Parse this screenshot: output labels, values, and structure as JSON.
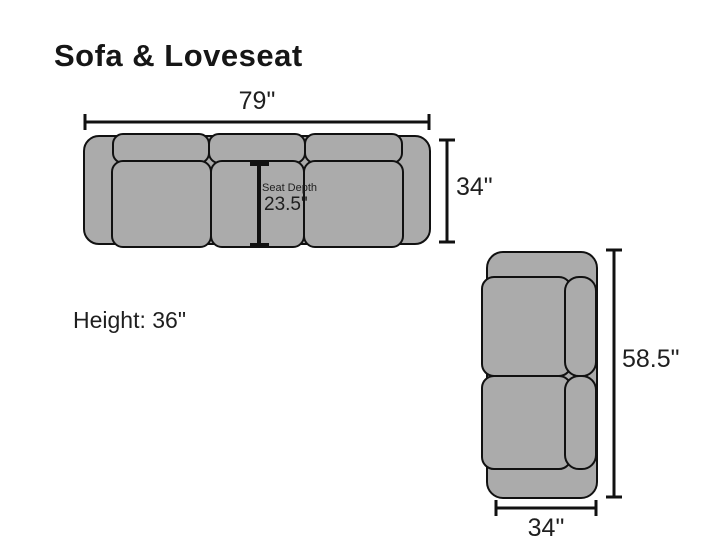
{
  "title": "Sofa & Loveseat",
  "colors": {
    "cushion_fill": "#ababab",
    "outline": "#111111",
    "dimension_line": "#111111",
    "text": "#1f1f1f",
    "background": "#ffffff"
  },
  "sofa": {
    "width": "79\"",
    "depth": "34\"",
    "seat_depth_label": "Seat Depth",
    "seat_depth": "23.5\"",
    "height": "Height: 36\""
  },
  "loveseat": {
    "length": "58.5\"",
    "width": "34\""
  }
}
